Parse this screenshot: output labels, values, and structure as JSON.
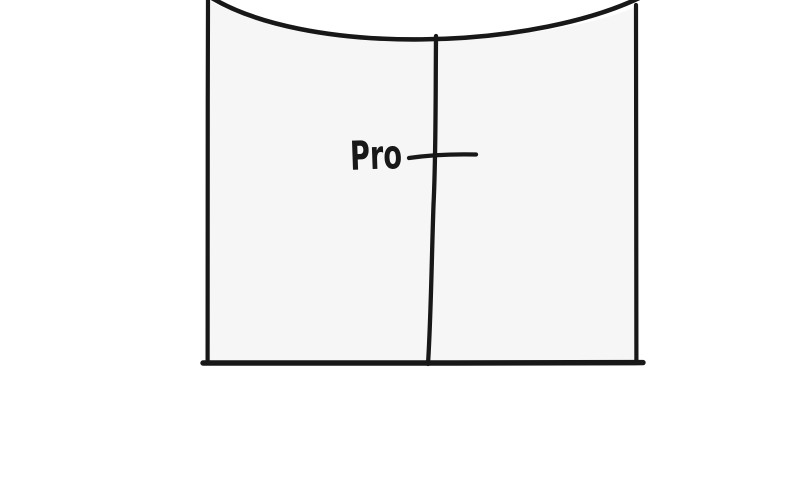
{
  "figure": {
    "type": "hand_drawn_t_chart_sketch",
    "left_column_label": "Pro",
    "ink_color": "#181818",
    "panel_fill_color": "#f6f6f6",
    "background_color": "#ffffff"
  }
}
